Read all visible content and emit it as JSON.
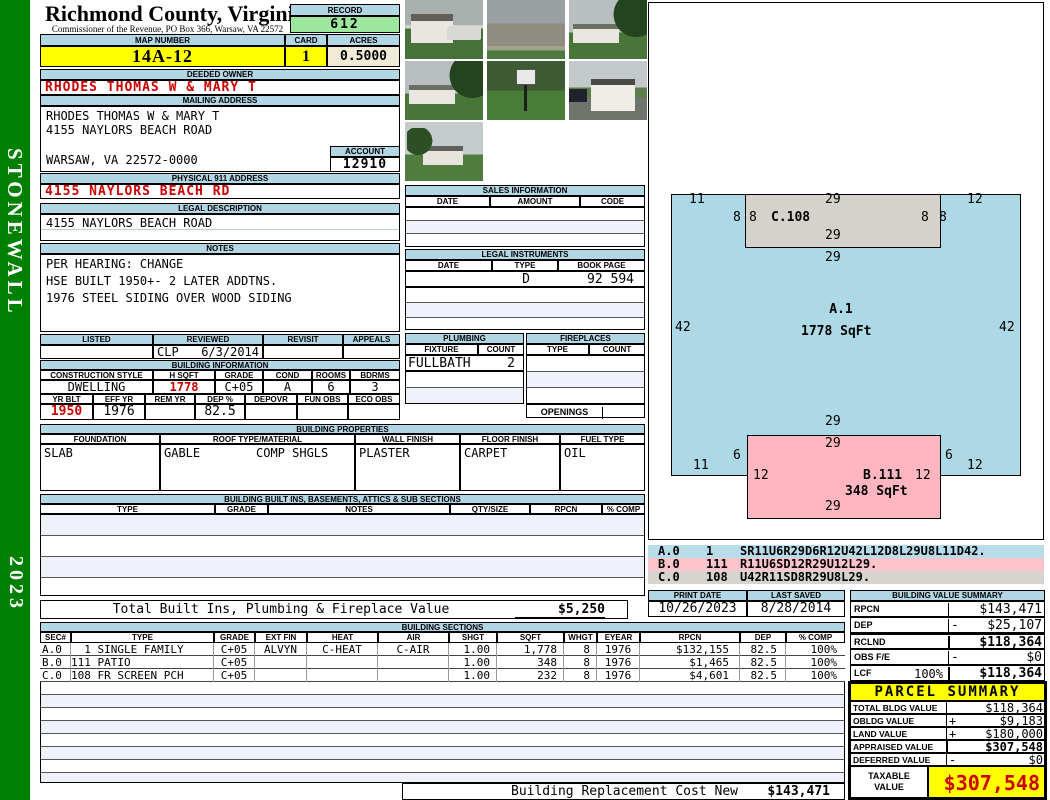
{
  "colors": {
    "sidebar_green": "#008000",
    "header_blue": "#b3d6e4",
    "highlight_yellow": "#ffff00",
    "record_green": "#9de69d",
    "acres_cream": "#f0ead6",
    "alert_red": "#cc0000",
    "sketch_blue": "#add8e6",
    "sketch_pink": "#ffb6c1",
    "sketch_gray": "#d4d2ca"
  },
  "sidebar": {
    "district": "STONEWALL",
    "year": "2023"
  },
  "header": {
    "county": "Richmond County, Virginia",
    "subtitle": "Commissioner of the Revenue, PO Box 366, Warsaw, VA 22572",
    "record_label": "RECORD",
    "record_value": "612",
    "map_label": "MAP NUMBER",
    "map_value": "14A-12",
    "card_label": "CARD",
    "card_value": "1",
    "acres_label": "ACRES",
    "acres_value": "0.5000"
  },
  "owner": {
    "deeded_label": "DEEDED OWNER",
    "deeded_value": "RHODES THOMAS W & MARY T",
    "mailing_label": "MAILING ADDRESS",
    "mail_name": "RHODES THOMAS W & MARY T",
    "mail_street": "4155 NAYLORS BEACH ROAD",
    "mail_city": "WARSAW, VA 22572-0000",
    "account_label": "ACCOUNT",
    "account_value": "12910",
    "physical_label": "PHYSICAL 911 ADDRESS",
    "physical_value": "4155 NAYLORS BEACH RD",
    "legal_label": "LEGAL DESCRIPTION",
    "legal_value": "4155 NAYLORS BEACH ROAD",
    "notes_label": "NOTES",
    "notes": [
      "PER HEARING: CHANGE",
      "HSE BUILT 1950+- 2 LATER ADDTNS.",
      "1976 STEEL SIDING OVER WOOD SIDING"
    ]
  },
  "review": {
    "labels": [
      "LISTED",
      "REVIEWED",
      "REVISIT",
      "APPEALS"
    ],
    "reviewer": "CLP",
    "date": "6/3/2014"
  },
  "building_info": {
    "label": "BUILDING INFORMATION",
    "row1_labels": [
      "CONSTRUCTION STYLE",
      "H SQFT",
      "GRADE",
      "COND",
      "ROOMS",
      "BDRMS"
    ],
    "row1_values": [
      "DWELLING",
      "1778",
      "C+05",
      "A",
      "6",
      "3"
    ],
    "row2_labels": [
      "YR BLT",
      "EFF YR",
      "REM YR",
      "DEP %",
      "DEPOVR",
      "FUN OBS",
      "ECO OBS"
    ],
    "row2_values": [
      "1950",
      "1976",
      "",
      "82.5",
      "",
      "",
      ""
    ]
  },
  "building_props": {
    "label": "BUILDING PROPERTIES",
    "col_labels": [
      "FOUNDATION",
      "ROOF TYPE/MATERIAL",
      "WALL FINISH",
      "FLOOR FINISH",
      "FUEL TYPE"
    ],
    "foundation": "SLAB",
    "roof_type": "GABLE",
    "roof_material": "COMP SHGLS",
    "wall_finish": "PLASTER",
    "floor_finish": "CARPET",
    "fuel_type": "OIL"
  },
  "built_ins": {
    "label": "BUILDING BUILT INS, BASEMENTS, ATTICS & SUB SECTIONS",
    "col_labels": [
      "TYPE",
      "GRADE",
      "NOTES",
      "QTY/SIZE",
      "RPCN",
      "% COMP"
    ],
    "total_label": "Total Built Ins, Plumbing & Fireplace Value",
    "total_value": "$5,250"
  },
  "sales": {
    "label": "SALES INFORMATION",
    "col_labels": [
      "DATE",
      "AMOUNT",
      "CODE"
    ]
  },
  "legal_instruments": {
    "label": "LEGAL INSTRUMENTS",
    "col_labels": [
      "DATE",
      "TYPE",
      "BOOK PAGE"
    ],
    "type_value": "D",
    "book_page_value": "92 594"
  },
  "plumbing": {
    "label": "PLUMBING",
    "col_labels": [
      "FIXTURE",
      "COUNT"
    ],
    "fixture": "FULLBATH",
    "count": "2"
  },
  "fireplaces": {
    "label": "FIREPLACES",
    "col_labels": [
      "TYPE",
      "COUNT"
    ],
    "openings_label": "OPENINGS"
  },
  "sketch": {
    "labels": [
      "11",
      "8",
      "8",
      "C.108",
      "29",
      "29",
      "8",
      "8",
      "12",
      "29",
      "42",
      "A.1",
      "1778 SqFt",
      "42",
      "29",
      "29",
      "6",
      "6",
      "11",
      "12",
      "12",
      "B.111",
      "12",
      "348 SqFt",
      "29"
    ],
    "legend": [
      {
        "code": "A.0",
        "num": "1",
        "path": "SR11U6R29D6R12U42L12D8L29U8L11D42."
      },
      {
        "code": "B.0",
        "num": "111",
        "path": "R11U6SD12R29U12L29."
      },
      {
        "code": "C.0",
        "num": "108",
        "path": "U42R11SD8R29U8L29."
      }
    ]
  },
  "print_info": {
    "print_label": "PRINT DATE",
    "print_date": "10/26/2023",
    "saved_label": "LAST SAVED",
    "saved_date": "8/28/2014"
  },
  "building_value_summary": {
    "label": "BUILDING VALUE SUMMARY",
    "rows": [
      {
        "k": "RPCN",
        "pct": "",
        "op": "",
        "v": "$143,471"
      },
      {
        "k": "DEP",
        "pct": "",
        "op": "-",
        "v": "$25,107"
      },
      {
        "k": "RCLND",
        "pct": "",
        "op": "",
        "v": "$118,364"
      },
      {
        "k": "OBS F/E",
        "pct": "",
        "op": "-",
        "v": "$0"
      },
      {
        "k": "LCF",
        "pct": "100%",
        "op": "",
        "v": "$118,364"
      }
    ]
  },
  "building_sections": {
    "label": "BUILDING SECTIONS",
    "col_labels": [
      "SEC#",
      "TYPE",
      "GRADE",
      "EXT FIN",
      "HEAT",
      "AIR",
      "SHGT",
      "SQFT",
      "WHGT",
      "EYEAR",
      "RPCN",
      "DEP",
      "% COMP"
    ],
    "rows": [
      [
        "A.0",
        "  1 SINGLE FAMILY",
        "C+05",
        "ALVYN",
        "C-HEAT",
        "C-AIR",
        "1.00",
        "1,778",
        "8",
        "1976",
        "$132,155",
        "82.5",
        "100%"
      ],
      [
        "B.0",
        "111 PATIO",
        "C+05",
        "",
        "",
        "",
        "1.00",
        "348",
        "8",
        "1976",
        "$1,465",
        "82.5",
        "100%"
      ],
      [
        "C.0",
        "108 FR SCREEN PCH",
        "C+05",
        "",
        "",
        "",
        "1.00",
        "232",
        "8",
        "1976",
        "$4,601",
        "82.5",
        "100%"
      ]
    ]
  },
  "bottom": {
    "rcn_label": "Building Replacement Cost New",
    "rcn_value": "$143,471"
  },
  "parcel_summary": {
    "label": "PARCEL SUMMARY",
    "rows": [
      {
        "k": "TOTAL BLDG VALUE",
        "op": "",
        "v": "$118,364"
      },
      {
        "k": "OBLDG VALUE",
        "op": "+",
        "v": "$9,183"
      },
      {
        "k": "LAND VALUE",
        "op": "+",
        "v": "$180,000"
      },
      {
        "k": "APPRAISED VALUE",
        "op": "",
        "v": "$307,548"
      },
      {
        "k": "DEFERRED VALUE",
        "op": "-",
        "v": "$0"
      }
    ],
    "taxable_label_1": "TAXABLE",
    "taxable_label_2": "VALUE",
    "taxable_value": "$307,548"
  }
}
